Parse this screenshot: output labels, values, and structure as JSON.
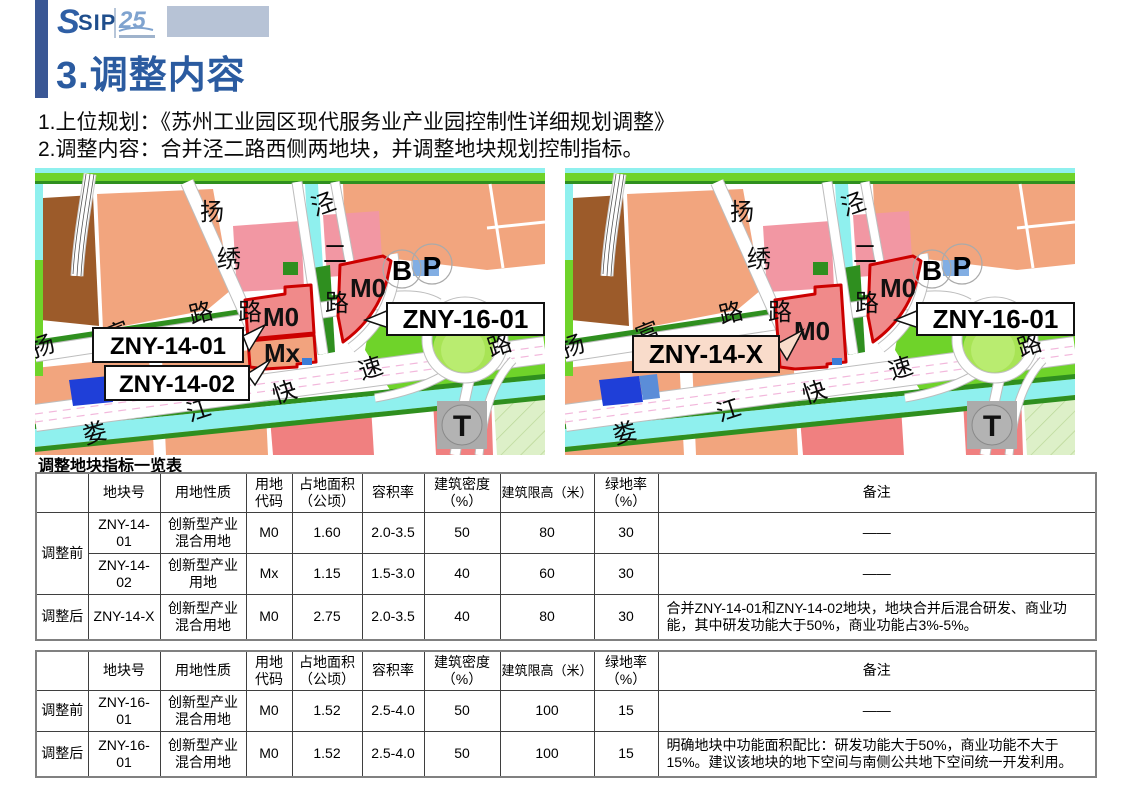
{
  "header": {
    "logo_sip": "SIP",
    "logo_anniversary": "25",
    "title": "3.调整内容"
  },
  "intro": {
    "line1": "1.上位规划：《苏州工业园区现代服务业产业园控制性详细规划调整》",
    "line2": "2.调整内容：合并泾二路西侧两地块，并调整地块规划控制指标。"
  },
  "maps": {
    "road_names": [
      "扬富路",
      "扬绣路",
      "泾二路",
      "娄江快速路"
    ],
    "markers": {
      "bus": "B",
      "parking": "P",
      "transit": "T"
    },
    "before": {
      "plot_labels": {
        "m0": "M0",
        "mx": "Mx",
        "m0_16": "M0"
      },
      "callouts": {
        "plot14a": "ZNY-14-01",
        "plot14b": "ZNY-14-02",
        "plot16": "ZNY-16-01"
      }
    },
    "after": {
      "plot_labels": {
        "m0": "M0",
        "m0_16": "M0"
      },
      "callouts": {
        "plot14": "ZNY-14-X",
        "plot16": "ZNY-16-01"
      }
    }
  },
  "table_section": {
    "title": "调整地块指标一览表",
    "headers": [
      "",
      "地块号",
      "用地性质",
      "用地代码",
      "占地面积（公顷）",
      "容积率",
      "建筑密度（%）",
      "建筑限高（米）",
      "绿地率（%）",
      "备注"
    ],
    "tables": [
      {
        "rows": [
          {
            "stage": "调整前",
            "stage_span": 2,
            "cells": [
              "ZNY-14-01",
              "创新型产业混合用地",
              "M0",
              "1.60",
              "2.0-3.5",
              "50",
              "80",
              "30",
              "——"
            ]
          },
          {
            "cells": [
              "ZNY-14-02",
              "创新型产业用地",
              "Mx",
              "1.15",
              "1.5-3.0",
              "40",
              "60",
              "30",
              "——"
            ]
          },
          {
            "stage": "调整后",
            "stage_span": 1,
            "cells": [
              "ZNY-14-X",
              "创新型产业混合用地",
              "M0",
              "2.75",
              "2.0-3.5",
              "40",
              "80",
              "30",
              "合并ZNY-14-01和ZNY-14-02地块，地块合并后混合研发、商业功能，其中研发功能大于50%，商业功能占3%-5%。"
            ]
          }
        ]
      },
      {
        "rows": [
          {
            "stage": "调整前",
            "stage_span": 1,
            "cells": [
              "ZNY-16-01",
              "创新型产业混合用地",
              "M0",
              "1.52",
              "2.5-4.0",
              "50",
              "100",
              "15",
              "——"
            ]
          },
          {
            "stage": "调整后",
            "stage_span": 1,
            "cells": [
              "ZNY-16-01",
              "创新型产业混合用地",
              "M0",
              "1.52",
              "2.5-4.0",
              "50",
              "100",
              "15",
              "明确地块中功能面积配比：研发功能大于50%，商业功能不大于15%。建议该地块的地下空间与南侧公共地下空间统一开发利用。"
            ]
          }
        ]
      }
    ]
  },
  "colors": {
    "title_blue": "#2B5BA0",
    "sidebar_blue": "#3A5795",
    "logo_block_blue": "#B7C3D6",
    "map": {
      "water": "#8FF0EE",
      "green": "#6FD32A",
      "dark_green": "#2F8F1F",
      "light_green_circle": "#A8E455",
      "light_green_circle2": "#B9EC70",
      "salmon": "#F2A57E",
      "pink": "#F297A3",
      "brown": "#9C5B2A",
      "block_red": "#F08080",
      "plot_red_fill": "#F08A8A",
      "plot_mx_fill": "#F2A37E",
      "plot_border": "#CC0000",
      "hatch_bg": "#DDF0C8",
      "hatch_line": "#BBD898",
      "pink_dash": "#F2B8DC",
      "callout_bg_after": "#F9DCCB",
      "blue_plot": "#1F3FD8",
      "blue_plot_light": "#5B8DD8",
      "blue_marker": "#82AEE3",
      "gray_transit": "#ABABAB"
    }
  }
}
